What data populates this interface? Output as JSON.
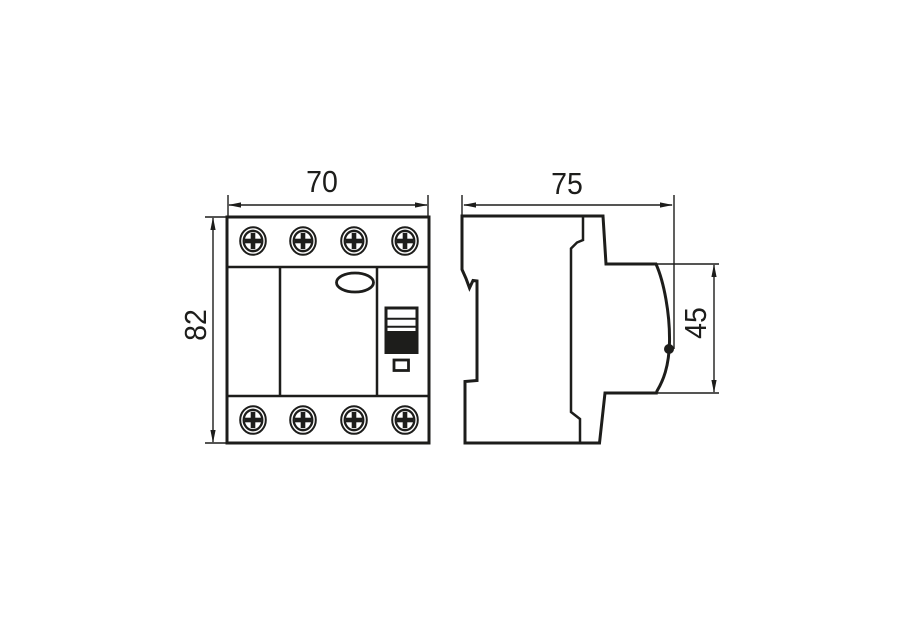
{
  "page": {
    "background": "#ffffff"
  },
  "drawing": {
    "type": "technical-dimension-drawing",
    "line_color": "#1d1d1b",
    "views": {
      "front": {
        "label": "front-view",
        "dims": {
          "width_mm": "70",
          "height_mm": "82"
        },
        "screws": {
          "top_count": 4,
          "bottom_count": 4
        },
        "features": {
          "test_button": "oval-button",
          "switch_window": "three-stripe-window",
          "toggle": "black-toggle",
          "indicator": "small-square-window"
        }
      },
      "side": {
        "label": "side-view",
        "dims": {
          "depth_mm": "75",
          "front_panel_height_mm": "45"
        },
        "features": {
          "din_rail_notch": "rear-clip-notch",
          "toggle_tip": "black-dot"
        }
      }
    }
  }
}
